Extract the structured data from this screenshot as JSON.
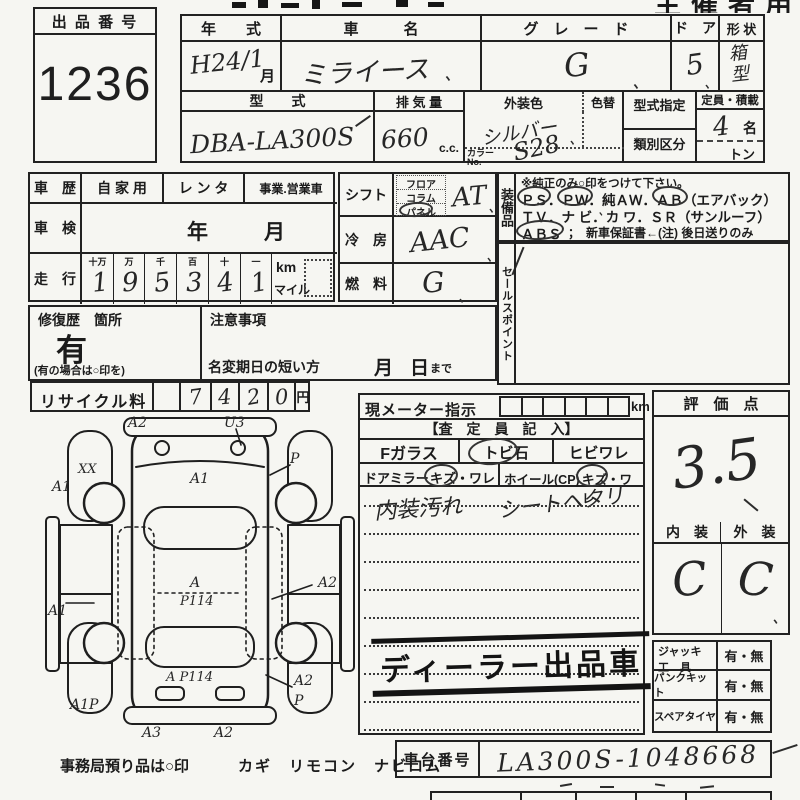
{
  "header": {
    "organizer_label": "主催者用"
  },
  "lot": {
    "label": "出 品 番 号",
    "number": "1236"
  },
  "spec": {
    "year_label": "年　　式",
    "year_value": "H24/1",
    "month_unit": "月",
    "name_label": "車　　　名",
    "name_value": "ミライース",
    "grade_label": "グ　レ　ー　ド",
    "grade_value": "G",
    "doors_label": "ド　ア",
    "doors_value": "5",
    "shape_label": "形 状",
    "shape_value": "箱型",
    "model_label": "型　　式",
    "model_value": "DBA-LA300S",
    "disp_label": "排 気 量",
    "disp_value": "660",
    "disp_unit": "c.c.",
    "color_label": "外装色",
    "color_value": "シルバー",
    "color_change_label": "色替",
    "color_no_label": "カラー No.",
    "color_no_value": "S28",
    "type_desig_label": "型式指定",
    "class_label": "類別区分",
    "cap_label": "定員・積載",
    "cap_value": "4",
    "cap_unit": "名",
    "load_unit": "トン"
  },
  "history": {
    "label": "車　歴",
    "opt1": "自 家 用",
    "opt2": "レ ン タ",
    "opt3": "事業.営業車",
    "inspection_label": "車　検",
    "inspection_year": "年",
    "inspection_month": "月",
    "odo_label": "走　行",
    "odo_cols": [
      "十万",
      "万",
      "千",
      "百",
      "十",
      "一"
    ],
    "odo_digits": [
      "1",
      "9",
      "5",
      "3",
      "4",
      "1"
    ],
    "unit_km": "km",
    "unit_mile": "マイル"
  },
  "controls": {
    "shift_label": "シフト",
    "shift_opt1": "フロア",
    "shift_opt2": "コラム",
    "shift_opt3": "パネル",
    "shift_value": "AT",
    "ac_label": "冷　房",
    "ac_value": "AAC",
    "fuel_label": "燃　料",
    "fuel_value": "G"
  },
  "equipment": {
    "label": "装備品",
    "note": "※純正のみ○印をつけて下さい。",
    "line1": "ＰＳ．ＰＷ．純ＡＷ．ＡＢ（エアバック）",
    "line2": "ＴＶ．ナ ビ．カ ワ．ＳＲ（サンルーフ）",
    "line3_left": "ＡＢＳ",
    "line3_right": "；　新車保証書←(注) 後日送りのみ"
  },
  "sales_point": {
    "label": "セールスポイント"
  },
  "repair": {
    "label": "修復歴　箇所",
    "value": "有",
    "note": "(有の場合は○印を)"
  },
  "caution": {
    "label": "注意事項",
    "rename_label": "名変期日の短い方",
    "month": "月",
    "day": "日",
    "made": "まで"
  },
  "recycle": {
    "label": "リサイクル料",
    "digits": [
      "7",
      "4",
      "2",
      "0"
    ],
    "unit": "円"
  },
  "inspector": {
    "meter_label": "現メーター指示",
    "meter_unit": "km",
    "entry_label": "【査　定　員　記　入】",
    "fglass": "Fガラス",
    "fglass_opt1": "トビ石",
    "fglass_opt2": "ヒビワレ",
    "mirror": "ドアミラー",
    "mirror_opt": "キズ・ワレ",
    "wheel": "ホイール(CP)",
    "wheel_opt": "キズ・ワレ",
    "note1": "内装汚れ",
    "note2": "シートヘタリ",
    "stamp": "ディーラー出品車"
  },
  "rating": {
    "label": "評　価　点",
    "score": "3.5",
    "interior_label": "内　装",
    "exterior_label": "外　装",
    "interior_value": "C",
    "exterior_value": "C"
  },
  "accessories": {
    "jack_label1": "ジャッキ",
    "jack_label2": "工　具",
    "jack_value": "有・無",
    "pank_label": "パンクキット",
    "pank_value": "有・無",
    "spare_label": "スペアタイヤ",
    "spare_value": "有・無"
  },
  "chassis": {
    "label": "車台番号",
    "value": "LA300S-1048668"
  },
  "footer": {
    "note": "事務局預り品は○印",
    "items": "カギ　リモコン　ナビロム"
  },
  "marks": {
    "tick": "、"
  },
  "car_diagram": {
    "annotations": [
      {
        "text": "A2"
      },
      {
        "text": "U3"
      },
      {
        "text": "XX"
      },
      {
        "text": "A1"
      },
      {
        "text": "P"
      },
      {
        "text": "A1"
      },
      {
        "text": "A1"
      },
      {
        "text": "A2"
      },
      {
        "text": "A"
      },
      {
        "text": "P114"
      },
      {
        "text": "A P114"
      },
      {
        "text": "A1P"
      },
      {
        "text": "A3"
      },
      {
        "text": "A2"
      },
      {
        "text": "A2"
      },
      {
        "text": "P"
      }
    ]
  }
}
